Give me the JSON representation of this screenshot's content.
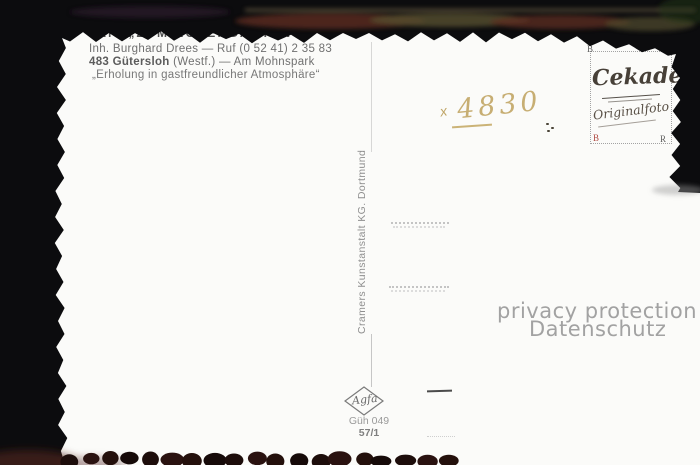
{
  "header": {
    "line1": "Café „ZUM ROSENGARTEN“",
    "line2": "Inh. Burghard Drees — Ruf (0 52 41) 2 35 83",
    "line3_bold": "483 Gütersloh",
    "line3_rest": " (Westf.) — Am Mohnspark",
    "line4": "„Erholung in gastfreundlicher Atmosphäre“"
  },
  "stamp_box": {
    "brand": "Cekade",
    "subtitle": "Originalfoto",
    "corner_tl": "B",
    "corner_tr": "B",
    "corner_bl": "B",
    "corner_br": "R"
  },
  "handwriting": {
    "mark": "x",
    "number": "4830",
    "color": "#c7ae73"
  },
  "spine": {
    "text": "Cramers Kunstanstalt KG. Dortmund"
  },
  "footer": {
    "logo": "Agfa",
    "code_line1": "Güh 049",
    "code_line2": "57/1"
  },
  "watermark": {
    "line1": "privacy protection",
    "line2": "Datenschutz"
  },
  "colors": {
    "background": "#0c0c0e",
    "card": "#fbfbf9",
    "handwriting": "#c7ae73",
    "stamp_corner_red": "#b04a42"
  }
}
